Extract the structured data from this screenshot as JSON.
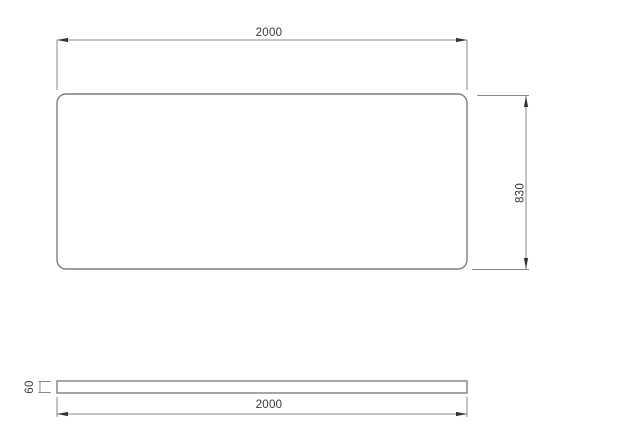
{
  "colors": {
    "background": "#ffffff",
    "outline": "#7f7f7f",
    "dimension_line": "#8a8a8a",
    "arrow": "#333333",
    "text": "#3a3a3a"
  },
  "top_view": {
    "width_dim": "2000",
    "height_dim": "830"
  },
  "side_view": {
    "length_dim": "2000",
    "thickness_dim": "60"
  }
}
